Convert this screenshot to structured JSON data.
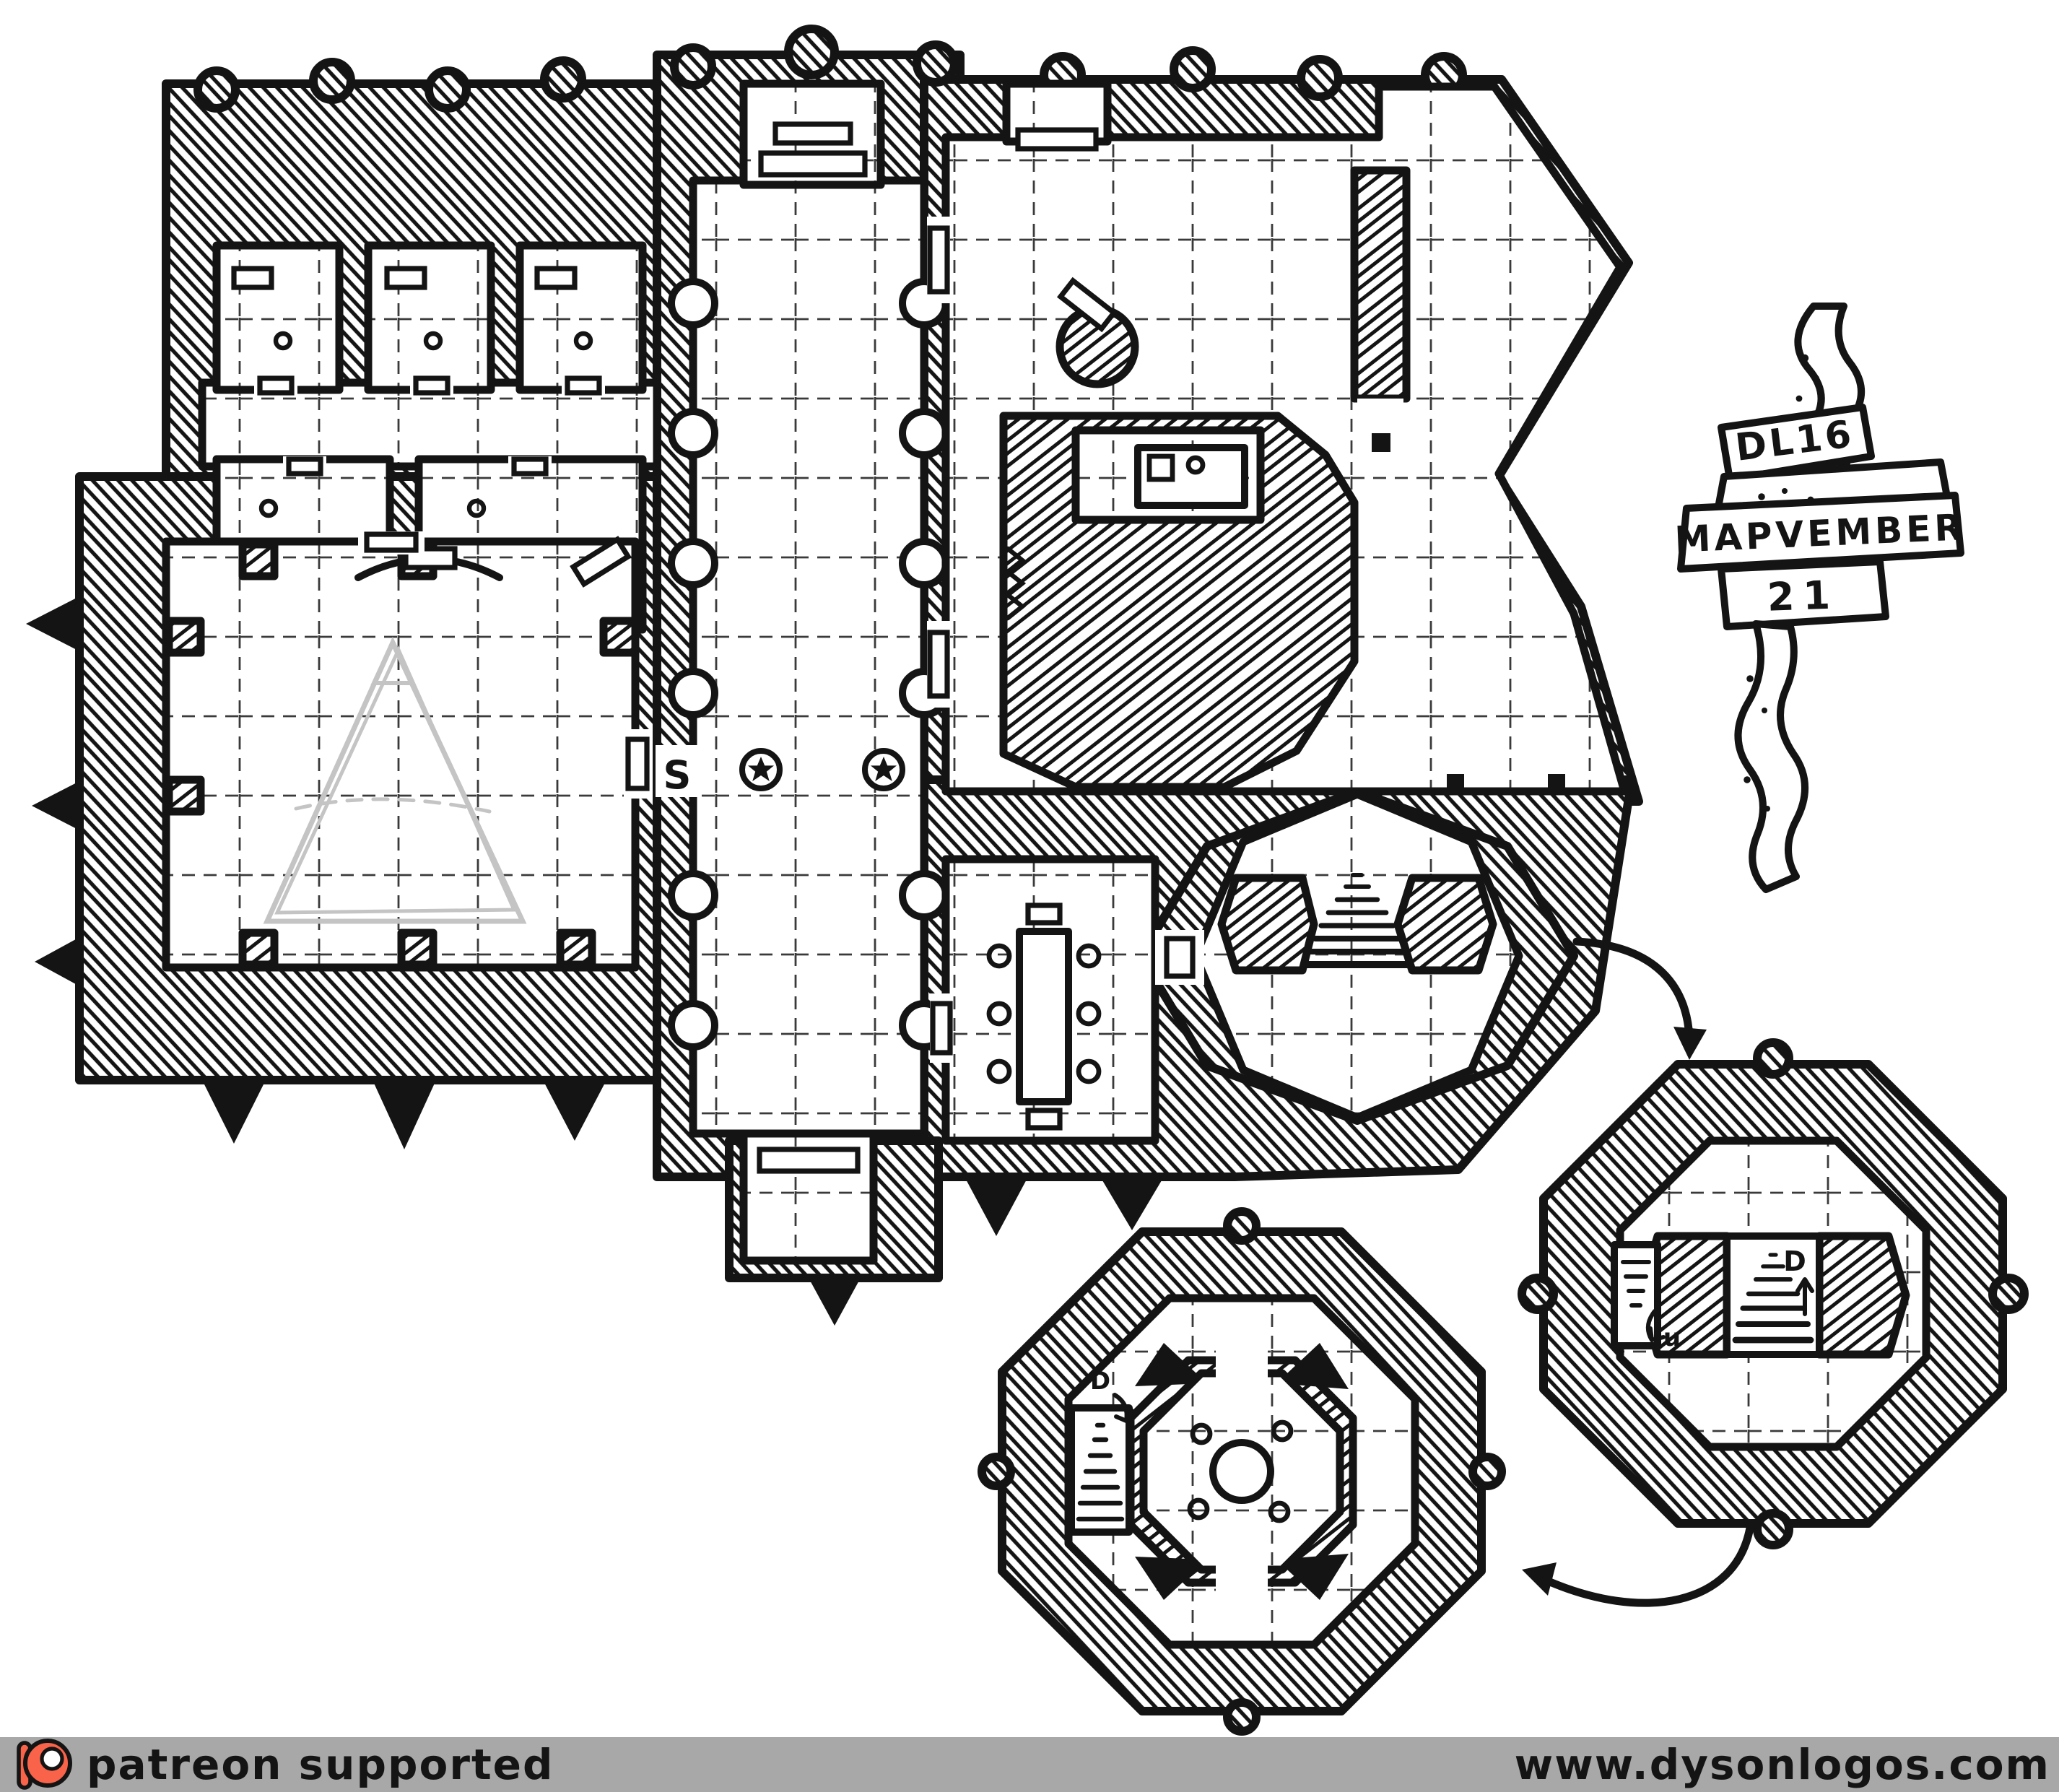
{
  "banner": {
    "code": "DL16",
    "title": "MAPVEMBER",
    "day": "21"
  },
  "map_labels": {
    "secret_door": "S",
    "stairs_up": "u",
    "stairs_down": "D"
  },
  "footer": {
    "left": "patreon supported",
    "right": "www.dysonlogos.com"
  },
  "colors": {
    "ink": "#141414",
    "paper": "#ffffff",
    "pencil": "#c4c4c4",
    "footer_bg": "#a8a8a8",
    "patreon_orange": "#f9634a"
  }
}
